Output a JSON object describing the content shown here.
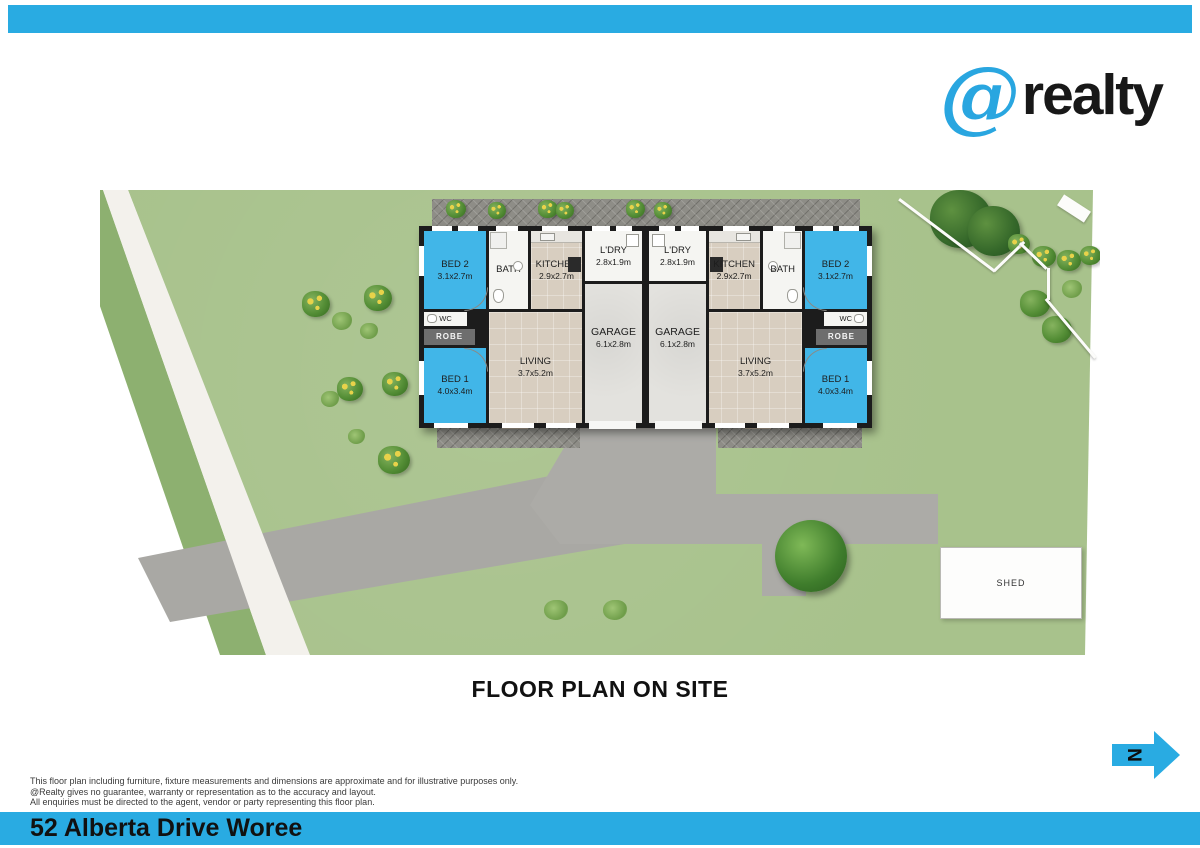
{
  "brand": {
    "at_symbol": "@",
    "name": "realty"
  },
  "page": {
    "plan_title": "FLOOR PLAN ON SITE",
    "address": "52 Alberta Drive Woree"
  },
  "compass": {
    "label": "N"
  },
  "site": {
    "shed_label": "SHED"
  },
  "units": [
    {
      "label": "left-unit",
      "rooms": {
        "bed2": {
          "name": "BED 2",
          "dim": "3.1x2.7m"
        },
        "bath": {
          "name": "BATH",
          "dim": ""
        },
        "kitchen": {
          "name": "KITCHEN",
          "dim": "2.9x2.7m"
        },
        "ldry": {
          "name": "L'DRY",
          "dim": "2.8x1.9m"
        },
        "garage": {
          "name": "GARAGE",
          "dim": "6.1x2.8m"
        },
        "wc": {
          "name": "WC",
          "dim": ""
        },
        "robe": {
          "name": "ROBE",
          "dim": ""
        },
        "bed1": {
          "name": "BED 1",
          "dim": "4.0x3.4m"
        },
        "living": {
          "name": "LIVING",
          "dim": "3.7x5.2m"
        }
      }
    },
    {
      "label": "right-unit",
      "rooms": {
        "bed2": {
          "name": "BED 2",
          "dim": "3.1x2.7m"
        },
        "bath": {
          "name": "BATH",
          "dim": ""
        },
        "kitchen": {
          "name": "KITCHEN",
          "dim": "2.9x2.7m"
        },
        "ldry": {
          "name": "L'DRY",
          "dim": "2.8x1.9m"
        },
        "garage": {
          "name": "GARAGE",
          "dim": "6.1x2.8m"
        },
        "wc": {
          "name": "WC",
          "dim": ""
        },
        "robe": {
          "name": "ROBE",
          "dim": ""
        },
        "bed1": {
          "name": "BED 1",
          "dim": "4.0x3.4m"
        },
        "living": {
          "name": "LIVING",
          "dim": "3.7x5.2m"
        }
      }
    }
  ],
  "disclaimer": {
    "line1": "This floor plan including furniture, fixture measurements and dimensions are approximate and for illustrative purposes only.",
    "line2": "@Realty gives no guarantee, warranty or representation as to the accuracy and layout.",
    "line3": "All enquiries must be directed to the agent, vendor or party representing this floor plan."
  },
  "colors": {
    "accent_cyan": "#29abe2",
    "bedroom_blue": "#41b6e8",
    "lawn_green": "#a8c28c",
    "driveway_grey": "#a9a8a4",
    "wall_black": "#1c1c1c"
  }
}
